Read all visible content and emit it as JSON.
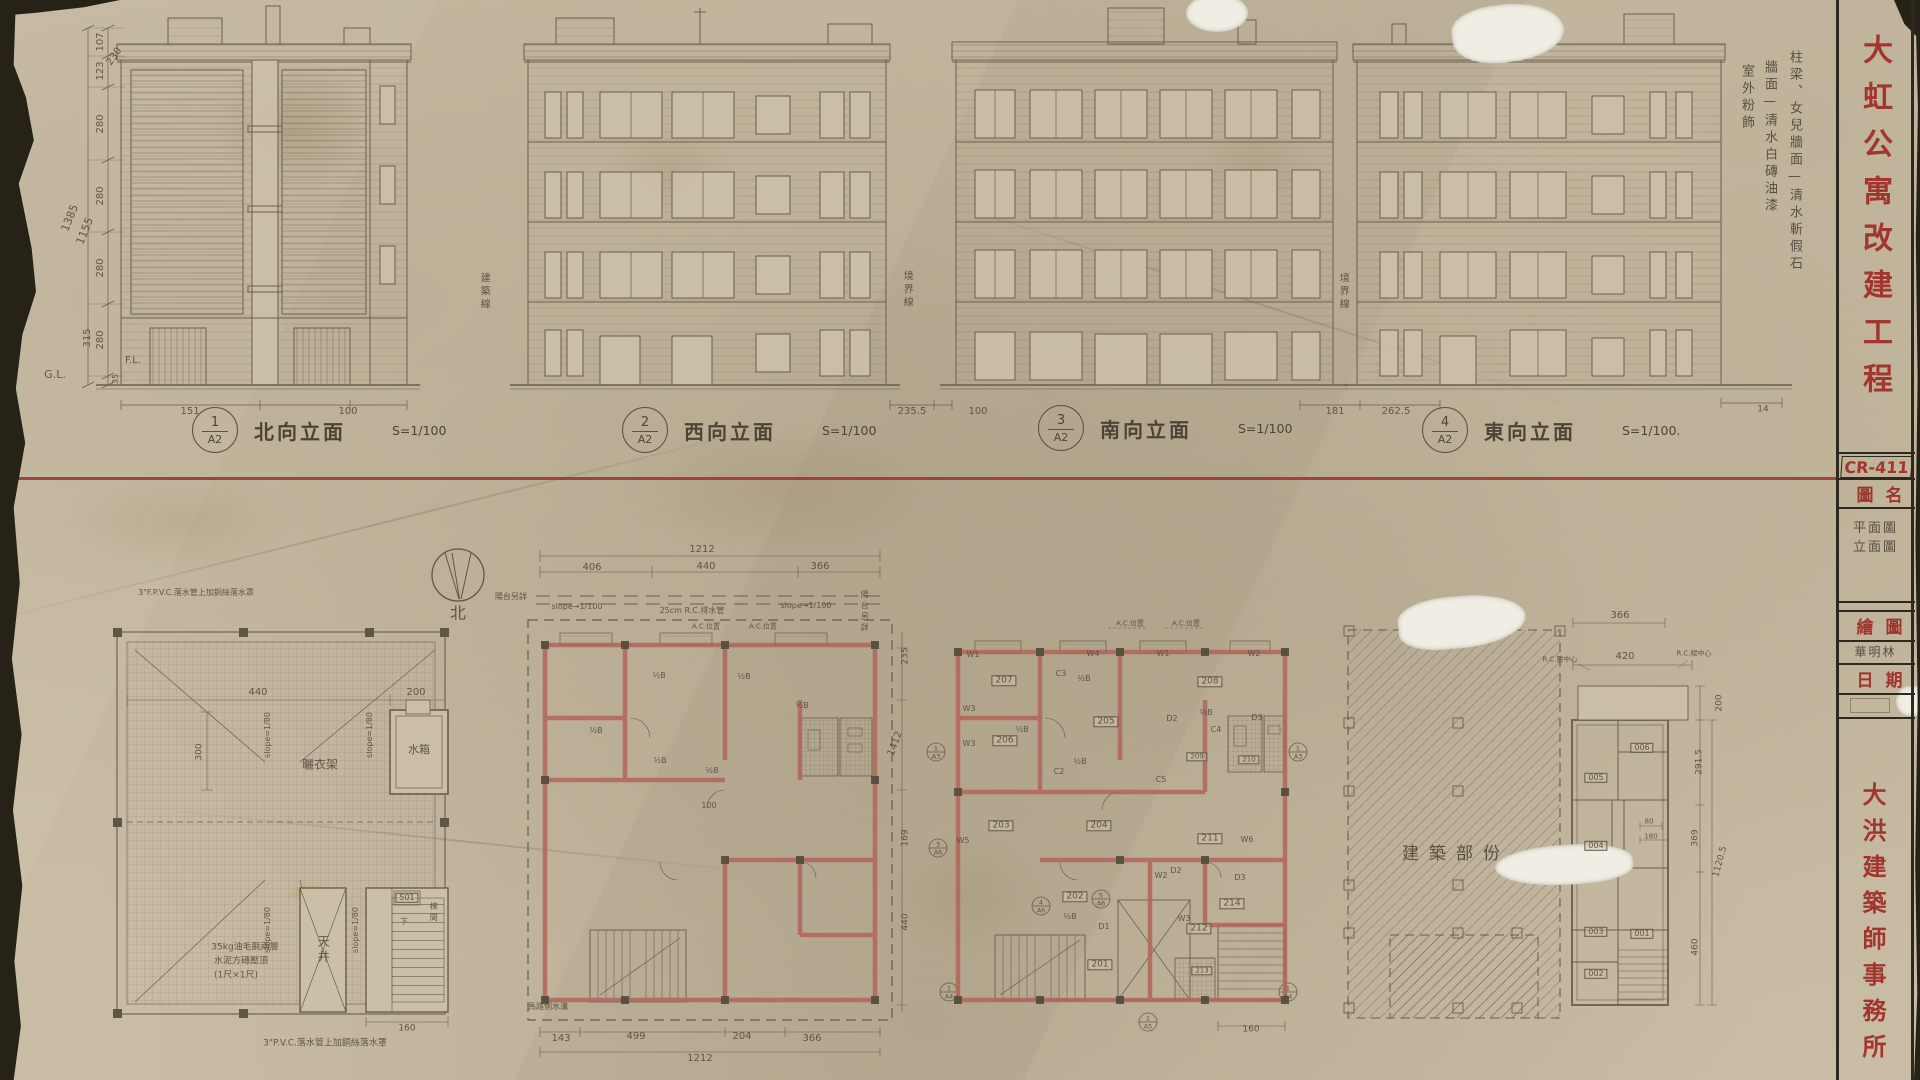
{
  "colors": {
    "paper": "#c9bda5",
    "pencil": "#564e40",
    "red_ink": "#a2362e",
    "wall_red": "#b2655a",
    "red_line": "#9d342d"
  },
  "title_block": {
    "project_title": "大虹公寓改建工程",
    "sheet_no": "CR-411",
    "fields": [
      {
        "label": "圖名",
        "value": "平面圖\n立面圖"
      },
      {
        "label": "繪圖",
        "value": "華明林"
      },
      {
        "label": "日期",
        "value": ""
      }
    ],
    "firm": "大洪建築師事務所"
  },
  "finish_notes": [
    "柱梁、女兒牆面—清水斬假石",
    "牆面—清水白磚油漆",
    "室外粉飾"
  ],
  "elevation_labels": [
    {
      "num": "1",
      "sheet": "A2",
      "name": "北向立面",
      "scale": "S=1/100"
    },
    {
      "num": "2",
      "sheet": "A2",
      "name": "西向立面",
      "scale": "S=1/100"
    },
    {
      "num": "3",
      "sheet": "A2",
      "name": "南向立面",
      "scale": "S=1/100"
    },
    {
      "num": "4",
      "sheet": "A2",
      "name": "東向立面",
      "scale": "S=1/100."
    }
  ],
  "annotations": [
    {
      "t": "107",
      "x": 101,
      "y": 42,
      "s": 10,
      "r": -90,
      "n": "dim"
    },
    {
      "t": "123",
      "x": 101,
      "y": 71,
      "s": 10,
      "r": -90,
      "n": "dim"
    },
    {
      "t": "230",
      "x": 115,
      "y": 57,
      "s": 10,
      "r": -55,
      "n": "dim"
    },
    {
      "t": "280",
      "x": 101,
      "y": 124,
      "s": 10,
      "r": -90,
      "n": "dim"
    },
    {
      "t": "280",
      "x": 101,
      "y": 196,
      "s": 10,
      "r": -90,
      "n": "dim"
    },
    {
      "t": "280",
      "x": 101,
      "y": 268,
      "s": 10,
      "r": -90,
      "n": "dim"
    },
    {
      "t": "280",
      "x": 101,
      "y": 340,
      "s": 10,
      "r": -90,
      "n": "dim"
    },
    {
      "t": "315",
      "x": 88,
      "y": 338,
      "s": 10,
      "r": -90,
      "n": "dim"
    },
    {
      "t": "35",
      "x": 116,
      "y": 379,
      "s": 8,
      "r": -90,
      "n": "dim"
    },
    {
      "t": "1385",
      "x": 70,
      "y": 218,
      "s": 11,
      "r": -68,
      "n": "dim"
    },
    {
      "t": "1155",
      "x": 85,
      "y": 231,
      "s": 11,
      "r": -68,
      "n": "dim"
    },
    {
      "t": "G.L.",
      "x": 55,
      "y": 375,
      "s": 11,
      "n": "label"
    },
    {
      "t": "F.L.",
      "x": 133,
      "y": 361,
      "s": 10,
      "n": "label"
    },
    {
      "t": "151",
      "x": 190,
      "y": 412,
      "s": 10,
      "n": "dim"
    },
    {
      "t": "100",
      "x": 348,
      "y": 412,
      "s": 10,
      "n": "dim"
    },
    {
      "t": "235.5",
      "x": 912,
      "y": 412,
      "s": 10,
      "n": "dim"
    },
    {
      "t": "100",
      "x": 978,
      "y": 412,
      "s": 10,
      "n": "dim"
    },
    {
      "t": "181",
      "x": 1335,
      "y": 412,
      "s": 10,
      "n": "dim"
    },
    {
      "t": "262.5",
      "x": 1396,
      "y": 412,
      "s": 10,
      "n": "dim"
    },
    {
      "t": "14",
      "x": 1763,
      "y": 410,
      "s": 9,
      "n": "dim"
    },
    {
      "t": "建築線",
      "x": 483,
      "y": 292,
      "s": 10,
      "v": 1,
      "n": "note"
    },
    {
      "t": "境界線",
      "x": 906,
      "y": 290,
      "s": 10,
      "v": 1,
      "n": "note"
    },
    {
      "t": "境界線",
      "x": 1342,
      "y": 292,
      "s": 10,
      "v": 1,
      "n": "note"
    },
    {
      "t": "北",
      "x": 458,
      "y": 614,
      "s": 16,
      "n": "label"
    },
    {
      "t": "440",
      "x": 258,
      "y": 693,
      "s": 10,
      "n": "dim"
    },
    {
      "t": "200",
      "x": 416,
      "y": 693,
      "s": 10,
      "n": "dim"
    },
    {
      "t": "300",
      "x": 200,
      "y": 752,
      "s": 9,
      "r": -90,
      "n": "dim"
    },
    {
      "t": "slope=1/80",
      "x": 268,
      "y": 735,
      "s": 8,
      "r": -90,
      "n": "note"
    },
    {
      "t": "slope=1/80",
      "x": 370,
      "y": 735,
      "s": 8,
      "r": -90,
      "n": "note"
    },
    {
      "t": "slope=1/80",
      "x": 268,
      "y": 930,
      "s": 8,
      "r": -90,
      "n": "note"
    },
    {
      "t": "slope=1/80",
      "x": 356,
      "y": 930,
      "s": 8,
      "r": -90,
      "n": "note"
    },
    {
      "t": "曬衣架",
      "x": 320,
      "y": 765,
      "s": 12,
      "n": "label"
    },
    {
      "t": "水箱",
      "x": 419,
      "y": 750,
      "s": 11,
      "n": "label"
    },
    {
      "t": "35kg油毛氈兩層",
      "x": 245,
      "y": 948,
      "s": 9,
      "n": "note"
    },
    {
      "t": "水泥方磚壓頂",
      "x": 241,
      "y": 962,
      "s": 9,
      "n": "note"
    },
    {
      "t": "(1尺×1尺)",
      "x": 236,
      "y": 976,
      "s": 9,
      "n": "note"
    },
    {
      "t": "天井",
      "x": 323,
      "y": 950,
      "s": 12,
      "v": 1,
      "n": "label"
    },
    {
      "t": "501",
      "x": 407,
      "y": 898,
      "s": 8,
      "c": "box",
      "n": "room"
    },
    {
      "t": "梯間",
      "x": 433,
      "y": 913,
      "s": 8,
      "v": 1,
      "n": "label"
    },
    {
      "t": "下",
      "x": 404,
      "y": 922,
      "s": 8,
      "n": "label"
    },
    {
      "t": "160",
      "x": 407,
      "y": 1029,
      "s": 9,
      "n": "dim"
    },
    {
      "t": "3\"P.V.C.落水管上加銅絲落水罩",
      "x": 325,
      "y": 1044,
      "s": 9,
      "n": "note"
    },
    {
      "t": "3\"F.P.V.C.落水管上加銅絲落水罩",
      "x": 196,
      "y": 593,
      "s": 8,
      "n": "note"
    },
    {
      "t": "1212",
      "x": 702,
      "y": 550,
      "s": 10,
      "n": "dim"
    },
    {
      "t": "406",
      "x": 592,
      "y": 568,
      "s": 10,
      "n": "dim"
    },
    {
      "t": "440",
      "x": 706,
      "y": 567,
      "s": 10,
      "n": "dim"
    },
    {
      "t": "366",
      "x": 820,
      "y": 567,
      "s": 10,
      "n": "dim"
    },
    {
      "t": "slope→1/100",
      "x": 577,
      "y": 607,
      "s": 8,
      "n": "note"
    },
    {
      "t": "25cm R.C.排水管",
      "x": 692,
      "y": 611,
      "s": 8,
      "n": "note"
    },
    {
      "t": "slope→1/100",
      "x": 806,
      "y": 606,
      "s": 8,
      "n": "note"
    },
    {
      "t": "A.C.位置",
      "x": 706,
      "y": 627,
      "s": 7,
      "n": "note"
    },
    {
      "t": "A.C.位置",
      "x": 763,
      "y": 627,
      "s": 7,
      "n": "note"
    },
    {
      "t": "陽台另詳",
      "x": 511,
      "y": 597,
      "s": 8,
      "n": "note"
    },
    {
      "t": "陽台另詳",
      "x": 864,
      "y": 612,
      "s": 8,
      "v": 1,
      "n": "note"
    },
    {
      "t": "½B",
      "x": 659,
      "y": 676,
      "s": 8,
      "n": "note"
    },
    {
      "t": "½B",
      "x": 744,
      "y": 677,
      "s": 8,
      "n": "note"
    },
    {
      "t": "½B",
      "x": 802,
      "y": 706,
      "s": 8,
      "n": "note"
    },
    {
      "t": "½B",
      "x": 596,
      "y": 731,
      "s": 8,
      "n": "note"
    },
    {
      "t": "½B",
      "x": 660,
      "y": 761,
      "s": 8,
      "n": "note"
    },
    {
      "t": "½B",
      "x": 712,
      "y": 771,
      "s": 8,
      "n": "note"
    },
    {
      "t": "100",
      "x": 709,
      "y": 806,
      "s": 8,
      "n": "dim"
    },
    {
      "t": "馬路側水溝",
      "x": 548,
      "y": 1007,
      "s": 8,
      "n": "note"
    },
    {
      "t": "143",
      "x": 561,
      "y": 1039,
      "s": 10,
      "n": "dim"
    },
    {
      "t": "499",
      "x": 636,
      "y": 1037,
      "s": 10,
      "n": "dim"
    },
    {
      "t": "204",
      "x": 742,
      "y": 1037,
      "s": 10,
      "n": "dim"
    },
    {
      "t": "366",
      "x": 812,
      "y": 1039,
      "s": 10,
      "n": "dim"
    },
    {
      "t": "1212",
      "x": 700,
      "y": 1059,
      "s": 10,
      "n": "dim"
    },
    {
      "t": "235",
      "x": 906,
      "y": 656,
      "s": 9,
      "r": -90,
      "n": "dim"
    },
    {
      "t": "1412",
      "x": 896,
      "y": 744,
      "s": 10,
      "r": -70,
      "n": "dim"
    },
    {
      "t": "169",
      "x": 906,
      "y": 838,
      "s": 9,
      "r": -90,
      "n": "dim"
    },
    {
      "t": "440",
      "x": 906,
      "y": 922,
      "s": 9,
      "r": -90,
      "n": "dim"
    },
    {
      "t": "A.C.位置",
      "x": 1130,
      "y": 624,
      "s": 7,
      "n": "note"
    },
    {
      "t": "A.C.位置",
      "x": 1186,
      "y": 624,
      "s": 7,
      "n": "note"
    },
    {
      "t": "W1",
      "x": 973,
      "y": 655,
      "s": 8,
      "n": "tag"
    },
    {
      "t": "W4",
      "x": 1093,
      "y": 654,
      "s": 8,
      "n": "tag"
    },
    {
      "t": "W1",
      "x": 1163,
      "y": 654,
      "s": 8,
      "n": "tag"
    },
    {
      "t": "W2",
      "x": 1254,
      "y": 654,
      "s": 8,
      "n": "tag"
    },
    {
      "t": "W3",
      "x": 969,
      "y": 709,
      "s": 8,
      "n": "tag"
    },
    {
      "t": "W3",
      "x": 969,
      "y": 744,
      "s": 8,
      "n": "tag"
    },
    {
      "t": "W5",
      "x": 963,
      "y": 841,
      "s": 8,
      "n": "tag"
    },
    {
      "t": "W6",
      "x": 1247,
      "y": 840,
      "s": 8,
      "n": "tag"
    },
    {
      "t": "W2",
      "x": 1161,
      "y": 876,
      "s": 8,
      "n": "tag"
    },
    {
      "t": "W3",
      "x": 1184,
      "y": 919,
      "s": 8,
      "n": "tag"
    },
    {
      "t": "D1",
      "x": 1104,
      "y": 927,
      "s": 8,
      "n": "tag"
    },
    {
      "t": "D2",
      "x": 1172,
      "y": 719,
      "s": 8,
      "n": "tag"
    },
    {
      "t": "D2",
      "x": 1176,
      "y": 871,
      "s": 8,
      "n": "tag"
    },
    {
      "t": "D3",
      "x": 1257,
      "y": 718,
      "s": 8,
      "n": "tag"
    },
    {
      "t": "D3",
      "x": 1240,
      "y": 878,
      "s": 8,
      "n": "tag"
    },
    {
      "t": "C2",
      "x": 1059,
      "y": 772,
      "s": 8,
      "n": "tag"
    },
    {
      "t": "C3",
      "x": 1061,
      "y": 674,
      "s": 8,
      "n": "tag"
    },
    {
      "t": "C4",
      "x": 1216,
      "y": 730,
      "s": 8,
      "n": "tag"
    },
    {
      "t": "C5",
      "x": 1161,
      "y": 780,
      "s": 8,
      "n": "tag"
    },
    {
      "t": "½B",
      "x": 1084,
      "y": 679,
      "s": 8,
      "n": "note"
    },
    {
      "t": "½B",
      "x": 1206,
      "y": 713,
      "s": 8,
      "n": "note"
    },
    {
      "t": "½B",
      "x": 1022,
      "y": 730,
      "s": 8,
      "n": "note"
    },
    {
      "t": "½B",
      "x": 1080,
      "y": 762,
      "s": 8,
      "n": "note"
    },
    {
      "t": "½B",
      "x": 1070,
      "y": 917,
      "s": 8,
      "n": "note"
    },
    {
      "t": "207",
      "x": 1004,
      "y": 681,
      "s": 9,
      "c": "box",
      "n": "room"
    },
    {
      "t": "206",
      "x": 1005,
      "y": 741,
      "s": 9,
      "c": "box",
      "n": "room"
    },
    {
      "t": "205",
      "x": 1106,
      "y": 722,
      "s": 9,
      "c": "box",
      "n": "room"
    },
    {
      "t": "208",
      "x": 1210,
      "y": 682,
      "s": 9,
      "c": "box",
      "n": "room"
    },
    {
      "t": "209",
      "x": 1197,
      "y": 757,
      "s": 7,
      "c": "box",
      "n": "room"
    },
    {
      "t": "210",
      "x": 1249,
      "y": 760,
      "s": 7,
      "c": "box",
      "n": "room"
    },
    {
      "t": "203",
      "x": 1001,
      "y": 826,
      "s": 9,
      "c": "box",
      "n": "room"
    },
    {
      "t": "204",
      "x": 1099,
      "y": 826,
      "s": 9,
      "c": "box",
      "n": "room"
    },
    {
      "t": "211",
      "x": 1210,
      "y": 839,
      "s": 9,
      "c": "box",
      "n": "room"
    },
    {
      "t": "202",
      "x": 1075,
      "y": 897,
      "s": 9,
      "c": "box",
      "n": "room"
    },
    {
      "t": "201",
      "x": 1100,
      "y": 965,
      "s": 9,
      "c": "box",
      "n": "room"
    },
    {
      "t": "212",
      "x": 1199,
      "y": 929,
      "s": 9,
      "c": "box",
      "n": "room"
    },
    {
      "t": "213",
      "x": 1202,
      "y": 971,
      "s": 7,
      "c": "box",
      "n": "room"
    },
    {
      "t": "214",
      "x": 1232,
      "y": 904,
      "s": 9,
      "c": "box",
      "n": "room"
    },
    {
      "t": "1",
      "x": 936,
      "y": 749,
      "s": 6.5,
      "n": "section-mark"
    },
    {
      "t": "A3",
      "x": 936,
      "y": 757,
      "s": 6.5,
      "n": "section-mark"
    },
    {
      "t": "1",
      "x": 1298,
      "y": 749,
      "s": 6.5,
      "n": "section-mark"
    },
    {
      "t": "A3",
      "x": 1298,
      "y": 757,
      "s": 6.5,
      "n": "section-mark"
    },
    {
      "t": "1",
      "x": 949,
      "y": 989,
      "s": 6.5,
      "n": "section-mark"
    },
    {
      "t": "A4",
      "x": 949,
      "y": 997,
      "s": 6.5,
      "n": "section-mark"
    },
    {
      "t": "1",
      "x": 1288,
      "y": 989,
      "s": 6.5,
      "n": "section-mark"
    },
    {
      "t": "A4",
      "x": 1288,
      "y": 997,
      "s": 6.5,
      "n": "section-mark"
    },
    {
      "t": "4",
      "x": 1041,
      "y": 903,
      "s": 6.5,
      "n": "section-mark"
    },
    {
      "t": "A6",
      "x": 1041,
      "y": 911,
      "s": 6.5,
      "n": "section-mark"
    },
    {
      "t": "5",
      "x": 1101,
      "y": 896,
      "s": 6.5,
      "n": "section-mark"
    },
    {
      "t": "A6",
      "x": 1101,
      "y": 904,
      "s": 6.5,
      "n": "section-mark"
    },
    {
      "t": "1",
      "x": 1148,
      "y": 1019,
      "s": 6.5,
      "n": "section-mark"
    },
    {
      "t": "A5",
      "x": 1148,
      "y": 1027,
      "s": 6.5,
      "n": "section-mark"
    },
    {
      "t": "3",
      "x": 938,
      "y": 845,
      "s": 6.5,
      "n": "section-mark"
    },
    {
      "t": "A6",
      "x": 938,
      "y": 853,
      "s": 6.5,
      "n": "section-mark"
    },
    {
      "t": "160",
      "x": 1251,
      "y": 1030,
      "s": 9,
      "n": "dim"
    },
    {
      "t": "建築部份",
      "x": 1456,
      "y": 855,
      "s": 17,
      "c": "sp",
      "n": "label"
    },
    {
      "t": "366",
      "x": 1620,
      "y": 616,
      "s": 10,
      "n": "dim"
    },
    {
      "t": "R.C.簷中心",
      "x": 1560,
      "y": 660,
      "s": 7,
      "n": "note"
    },
    {
      "t": "420",
      "x": 1625,
      "y": 657,
      "s": 10,
      "n": "dim"
    },
    {
      "t": "R.C.樑中心",
      "x": 1694,
      "y": 654,
      "s": 7,
      "n": "note"
    },
    {
      "t": "200",
      "x": 1720,
      "y": 703,
      "s": 9,
      "r": -90,
      "n": "dim"
    },
    {
      "t": "291.5",
      "x": 1700,
      "y": 762,
      "s": 9,
      "r": -90,
      "n": "dim"
    },
    {
      "t": "369",
      "x": 1696,
      "y": 838,
      "s": 9,
      "r": -90,
      "n": "dim"
    },
    {
      "t": "1120.5",
      "x": 1721,
      "y": 862,
      "s": 9,
      "r": -75,
      "n": "dim"
    },
    {
      "t": "460",
      "x": 1696,
      "y": 947,
      "s": 9,
      "r": -90,
      "n": "dim"
    },
    {
      "t": "80",
      "x": 1649,
      "y": 822,
      "s": 7,
      "n": "dim"
    },
    {
      "t": "180",
      "x": 1651,
      "y": 837,
      "s": 7,
      "n": "dim"
    },
    {
      "t": "006",
      "x": 1642,
      "y": 748,
      "s": 8,
      "c": "box",
      "n": "room"
    },
    {
      "t": "005",
      "x": 1596,
      "y": 778,
      "s": 8,
      "c": "box",
      "n": "room"
    },
    {
      "t": "004",
      "x": 1596,
      "y": 846,
      "s": 8,
      "c": "box",
      "n": "room"
    },
    {
      "t": "003",
      "x": 1596,
      "y": 932,
      "s": 8,
      "c": "box",
      "n": "room"
    },
    {
      "t": "001",
      "x": 1642,
      "y": 934,
      "s": 8,
      "c": "box",
      "n": "room"
    },
    {
      "t": "002",
      "x": 1596,
      "y": 974,
      "s": 8,
      "c": "box",
      "n": "room"
    }
  ]
}
